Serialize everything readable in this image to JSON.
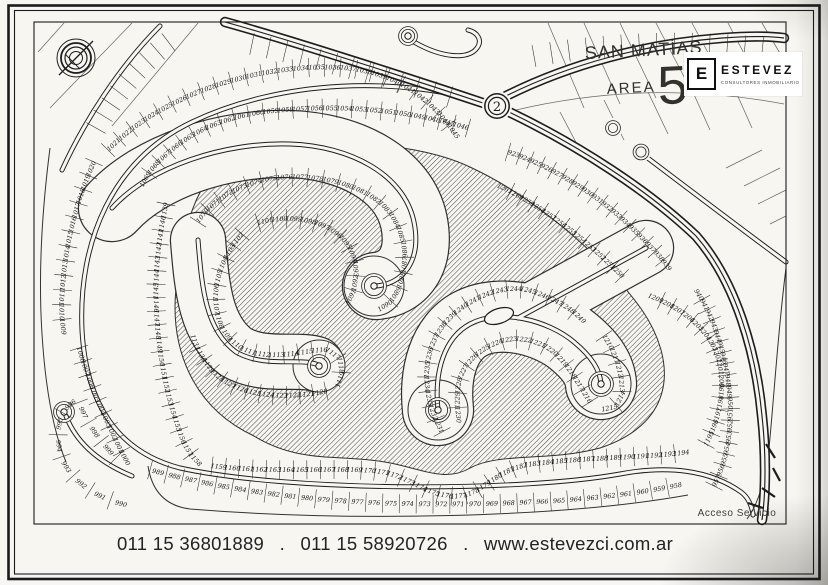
{
  "header": {
    "title_line1": "SAN MATÍAS",
    "title_area": "AREA",
    "title_number": "5"
  },
  "logo": {
    "letter": "E",
    "name": "ESTEVEZ",
    "tagline": "CONSULTORES INMOBILIARIOS"
  },
  "footer": {
    "phone1": "011 15 36801889",
    "dot1": ".",
    "phone2": "011 15 58920726",
    "dot2": ".",
    "website": "www.estevezci.com.ar"
  },
  "map": {
    "roundabout_label": "2",
    "access_label": "Acceso Servicio",
    "ink": "#1d1d1d",
    "paper": "#f7f6f1",
    "hatch_color": "#454545",
    "hatch_blob": "M 232,158 C 320,134 420,142 472,168 C 532,196 602,254 642,310 C 676,360 678,422 600,448 C 548,462 500,452 470,468 C 445,483 420,468 385,462 C 340,454 300,464 254,436 C 192,407 170,348 176,288 C 182,232 196,176 232,158 Z",
    "grid_lines": [
      "M 548,23 L 584,108",
      "M 584,23 L 620,104",
      "M 620,23 L 656,98",
      "M 656,23 L 692,92",
      "M 692,23 L 726,86",
      "M 728,23 L 758,80",
      "M 762,23 L 784,60",
      "M 516,110 C 610,88 700,88 784,104",
      "M 560,112 L 580,150",
      "M 604,100 L 624,140",
      "M 648,92 L 668,134",
      "M 692,90 L 710,130",
      "M 736,92 L 752,128",
      "M 726,168 L 762,150",
      "M 744,186 L 780,168",
      "M 758,204 L 786,190",
      "M 770,224 L 786,216",
      "M 64,23 L 38,52",
      "M 132,23 L 50,108",
      "M 198,23 L 112,126"
    ],
    "blank_rows": [
      {
        "path": "M 252,44 C 330,60 420,88 466,102",
        "count": 13
      },
      {
        "path": "M 534,56 C 612,42 700,40 780,50",
        "count": 14
      },
      {
        "path": "M 96,128 C 116,92 144,58 180,34",
        "count": 9
      }
    ],
    "corridors": [
      {
        "path": "M 112,208 C 150,166 225,142 290,144 C 350,146 404,174 414,222 C 422,262 402,284 376,286",
        "width": 66
      },
      {
        "path": "M 198,240 C 202,290 206,330 236,352 C 264,368 298,358 316,364",
        "width": 54
      },
      {
        "path": "M 438,410 C 434,372 444,338 470,324 C 500,308 548,320 574,342 C 592,357 600,370 601,384",
        "width": 70
      },
      {
        "path": "M 518,318 C 558,296 602,272 646,248",
        "width": 54
      }
    ],
    "roads": [
      {
        "name": "perimeter-road",
        "path": "M 497,106 C 400,74 280,80 192,122 C 112,160 78,242 82,330 C 86,404 118,452 180,468 C 290,492 520,492 620,474 C 668,465 710,470 741,492 C 748,497 752,506 753,515"
      },
      {
        "name": "street-spiral",
        "path": "M 112,208 C 150,166 225,142 290,144 C 350,146 404,174 414,222 C 422,262 402,284 376,286"
      },
      {
        "name": "street-hook",
        "path": "M 198,240 C 202,290 206,330 236,352 C 264,368 298,358 316,364"
      },
      {
        "name": "street-loop",
        "path": "M 438,410 C 434,372 444,338 470,324 C 500,308 548,320 574,342 C 592,357 600,370 601,384"
      },
      {
        "name": "street-loop-branch",
        "path": "M 518,318 C 558,296 602,272 646,248"
      },
      {
        "name": "street-knob",
        "path": "M 66,416 C 76,442 98,462 132,476"
      },
      {
        "name": "street-top-loop",
        "path": "M 414,42 C 442,58 468,60 477,48 C 483,40 477,32 468,30"
      },
      {
        "name": "road-topleft",
        "path": "M 62,170 C 85,120 120,66 160,26"
      },
      {
        "name": "road-northeast-parallel",
        "path": "M 645,156 C 690,190 740,228 786,262"
      }
    ],
    "thin_lines": [
      "M 50,148 C 42,210 38,272 42,334 C 45,382 52,428 66,462",
      "M 148,466 C 152,492 166,506 190,509 C 350,522 560,518 688,495",
      "M 786,268 C 778,330 774,398 769,448 C 765,482 757,506 747,519"
    ],
    "arterials": [
      {
        "name": "arterial-north",
        "path": "M 225,22 C 290,40 420,82 486,104"
      },
      {
        "name": "arterial-southeast",
        "path": "M 509,112 C 580,146 650,192 696,236 C 736,282 756,352 762,416 C 766,452 766,492 762,520"
      },
      {
        "name": "arterial-branch-ne",
        "path": "M 506,96 C 570,64 645,44 722,38 C 748,36 768,36 784,38"
      }
    ],
    "culdesacs": [
      {
        "cx": 374,
        "cy": 286,
        "white": 30,
        "ring": 11,
        "dot": true
      },
      {
        "cx": 319,
        "cy": 366,
        "white": 26,
        "ring": 10,
        "dot": true
      },
      {
        "cx": 438,
        "cy": 410,
        "white": 30,
        "ring": 11,
        "dot": true
      },
      {
        "cx": 601,
        "cy": 384,
        "white": 30,
        "ring": 11,
        "dot": true
      },
      {
        "cx": 64,
        "cy": 412,
        "white": 0,
        "ring": 9,
        "dot": true
      },
      {
        "cx": 408,
        "cy": 36,
        "white": 0,
        "ring": 8,
        "dot": true
      },
      {
        "cx": 613,
        "cy": 128,
        "white": 10,
        "ring": 6,
        "dot": false,
        "late": true
      },
      {
        "cx": 641,
        "cy": 152,
        "white": 10,
        "ring": 6.5,
        "dot": false,
        "late": true
      }
    ],
    "island": {
      "cx": 499,
      "cy": 316,
      "rx": 15,
      "ry": 7.5,
      "rot": -18
    },
    "service_marks": [
      "M 766,444 l 9,14",
      "M 773,468 l 7,13",
      "M 762,488 l 13,9",
      "M 748,503 l 15,5"
    ],
    "lot_rows": [
      {
        "name": "outer-top",
        "start": 1021,
        "end": 1045,
        "path": "M 108,150 C 165,92 265,62 345,68 C 402,73 436,105 458,138"
      },
      {
        "name": "outer-left",
        "start": 1020,
        "end": 1009,
        "path": "M 94,162 C 76,202 64,250 62,298 C 61,312 62,322 64,334"
      },
      {
        "name": "outer-left-lower",
        "start": 1008,
        "end": 1000,
        "path": "M 79,348 C 85,368 91,386 99,404 C 107,422 117,444 128,464"
      },
      {
        "name": "knob",
        "start": 999,
        "end": 990,
        "path": "M 116,458 C 100,442 86,422 78,400 C 58,408 54,436 62,458 C 70,480 96,500 132,506"
      },
      {
        "name": "outer-bottom",
        "start": 989,
        "end": 958,
        "path": "M 150,470 C 240,494 330,503 420,504 C 520,505 610,500 684,484"
      },
      {
        "name": "outer-right",
        "start": 957,
        "end": 940,
        "path": "M 714,486 C 726,462 732,434 730,402 C 728,366 718,324 696,290"
      },
      {
        "name": "outer-topright",
        "start": 923,
        "end": 939,
        "path": "M 508,152 C 552,166 600,196 634,230 C 650,246 662,258 670,270"
      },
      {
        "name": "inner-top",
        "start": 1046,
        "end": 1069,
        "path": "M 468,128 C 400,108 330,104 264,112 C 226,117 196,130 174,148 C 158,161 148,172 142,186"
      },
      {
        "name": "inner-left",
        "start": 1139,
        "end": 1158,
        "path": "M 166,204 C 158,242 154,282 157,322 C 160,362 168,402 182,438 C 187,450 193,458 200,464"
      },
      {
        "name": "inner-bottom",
        "start": 1159,
        "end": 1194,
        "path": "M 212,466 C 280,474 340,466 382,472 C 412,478 424,494 452,496 C 482,498 492,470 532,464 C 590,457 645,458 688,452"
      },
      {
        "name": "inner-right",
        "start": 1195,
        "end": 1209,
        "path": "M 706,444 C 720,418 726,388 718,358 C 710,330 682,308 650,296"
      },
      {
        "name": "inner-topright",
        "start": 1250,
        "end": 1261,
        "path": "M 622,276 C 592,246 558,218 522,198 C 514,193 506,189 499,186"
      },
      {
        "name": "spiral-outer",
        "start": 1070,
        "end": 1090,
        "path": "M 198,222 C 212,200 242,182 276,178 C 320,173 372,186 392,216 C 406,238 408,262 400,284 C 396,297 388,306 378,309"
      },
      {
        "name": "spiral-inner",
        "start": 1101,
        "end": 1091,
        "path": "M 258,223 C 285,215 316,218 336,233 C 352,245 358,263 355,282 C 354,291 351,298 347,303"
      },
      {
        "name": "hook-outer",
        "start": 1102,
        "end": 1119,
        "path": "M 242,234 C 228,250 218,270 216,292 C 214,318 224,340 246,350 C 270,360 300,352 320,350 C 332,350 340,357 341,367 C 342,375 340,381 337,386"
      },
      {
        "name": "hook-inner",
        "start": 1120,
        "end": 1131,
        "path": "M 326,391 C 300,397 270,397 248,391 C 230,386 216,377 208,365 C 200,355 196,345 193,336"
      },
      {
        "name": "loop-outer",
        "start": 1231,
        "end": 1249,
        "path": "M 442,432 C 430,410 424,386 428,362 C 432,336 446,318 466,305 C 486,292 512,284 534,292 C 554,299 572,308 584,322"
      },
      {
        "name": "loop-right",
        "start": 1210,
        "end": 1215,
        "path": "M 604,336 C 615,352 622,372 622,392 C 620,404 612,410 602,408"
      },
      {
        "name": "loop-inner",
        "start": 1216,
        "end": 1230,
        "path": "M 590,402 C 576,380 566,360 548,348 C 530,338 512,336 494,344 C 478,351 467,362 461,376 C 456,390 457,408 459,422"
      }
    ]
  }
}
